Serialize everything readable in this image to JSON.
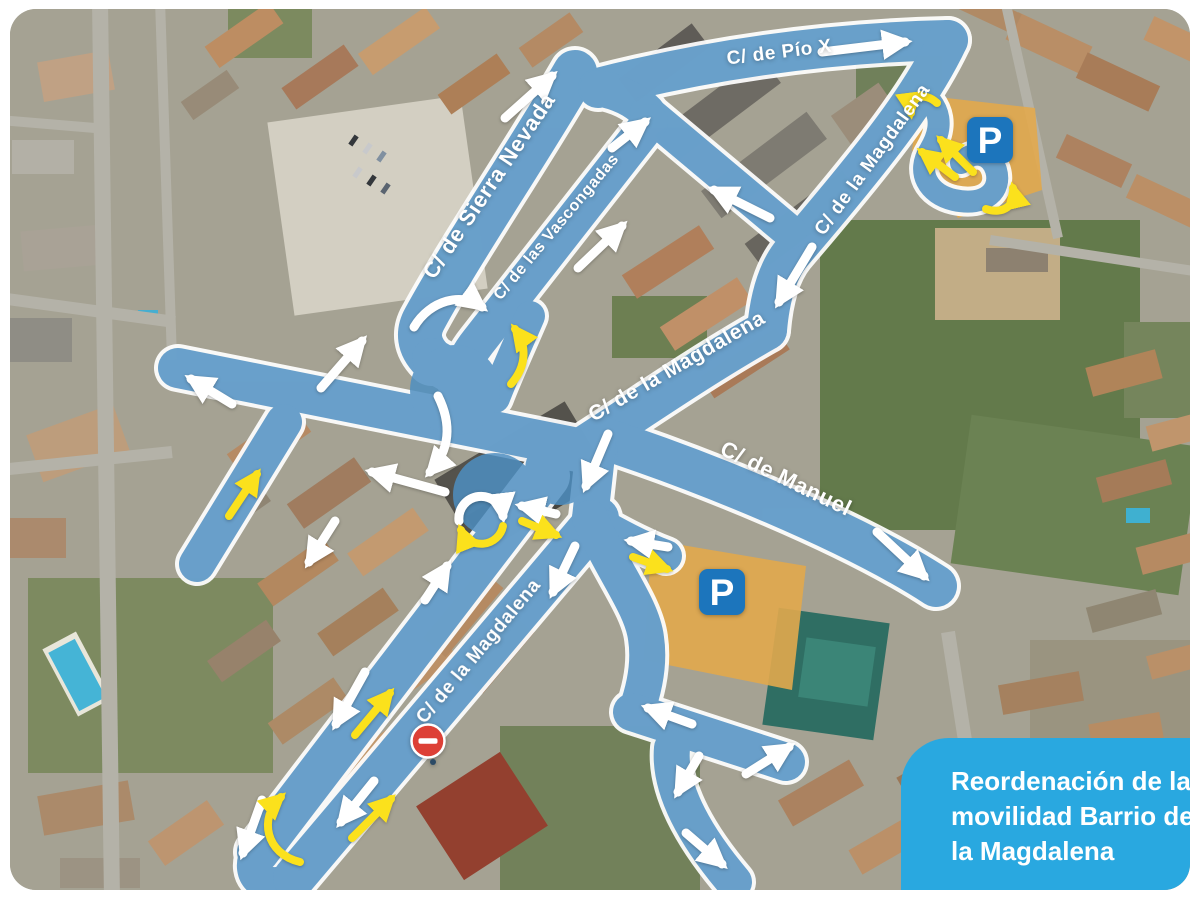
{
  "title_card": {
    "lines": [
      "Reordenación de la",
      "movilidad Barrio de",
      "la Magdalena"
    ]
  },
  "map": {
    "street_labels": [
      {
        "text": "C/ de Pío X",
        "x": 780,
        "y": 58,
        "angle": -7,
        "size": 19
      },
      {
        "text": "C/ de Sierra Nevada",
        "x": 495,
        "y": 190,
        "angle": -56,
        "size": 22
      },
      {
        "text": "C/ de las Vascongadas",
        "x": 560,
        "y": 230,
        "angle": -50,
        "size": 16
      },
      {
        "text": "C/ de la Magdalena",
        "x": 877,
        "y": 163,
        "angle": -54,
        "size": 19
      },
      {
        "text": "C/ de la Magdalena",
        "x": 680,
        "y": 372,
        "angle": -30,
        "size": 21
      },
      {
        "text": "C/ de Manuel",
        "x": 783,
        "y": 485,
        "angle": 26,
        "size": 22
      },
      {
        "text": "C/ de la Magdalena",
        "x": 483,
        "y": 655,
        "angle": -50,
        "size": 19
      }
    ],
    "parking_letter": "P",
    "parking_icons": [
      {
        "x": 990,
        "y": 140
      },
      {
        "x": 722,
        "y": 592
      }
    ],
    "no_entry_sign": {
      "x": 428,
      "y": 741
    },
    "arrows": {
      "straight": [
        {
          "x1": 822,
          "y1": 52,
          "x2": 905,
          "y2": 42,
          "color": "white"
        },
        {
          "x1": 505,
          "y1": 118,
          "x2": 552,
          "y2": 76,
          "color": "white"
        },
        {
          "x1": 612,
          "y1": 148,
          "x2": 645,
          "y2": 122,
          "color": "white"
        },
        {
          "x1": 578,
          "y1": 268,
          "x2": 622,
          "y2": 226,
          "color": "white"
        },
        {
          "x1": 770,
          "y1": 218,
          "x2": 714,
          "y2": 190,
          "color": "white"
        },
        {
          "x1": 812,
          "y1": 247,
          "x2": 779,
          "y2": 302,
          "color": "white"
        },
        {
          "x1": 608,
          "y1": 434,
          "x2": 586,
          "y2": 486,
          "color": "white"
        },
        {
          "x1": 556,
          "y1": 514,
          "x2": 522,
          "y2": 506,
          "color": "white"
        },
        {
          "x1": 522,
          "y1": 521,
          "x2": 556,
          "y2": 535,
          "color": "yellow"
        },
        {
          "x1": 575,
          "y1": 546,
          "x2": 553,
          "y2": 592,
          "color": "white"
        },
        {
          "x1": 425,
          "y1": 600,
          "x2": 447,
          "y2": 566,
          "color": "white"
        },
        {
          "x1": 668,
          "y1": 547,
          "x2": 631,
          "y2": 541,
          "color": "white"
        },
        {
          "x1": 633,
          "y1": 557,
          "x2": 667,
          "y2": 569,
          "color": "yellow"
        },
        {
          "x1": 877,
          "y1": 532,
          "x2": 924,
          "y2": 576,
          "color": "white"
        },
        {
          "x1": 232,
          "y1": 404,
          "x2": 191,
          "y2": 379,
          "color": "white"
        },
        {
          "x1": 321,
          "y1": 388,
          "x2": 362,
          "y2": 341,
          "color": "white"
        },
        {
          "x1": 229,
          "y1": 516,
          "x2": 257,
          "y2": 474,
          "color": "yellow"
        },
        {
          "x1": 445,
          "y1": 492,
          "x2": 372,
          "y2": 472,
          "color": "white"
        },
        {
          "x1": 335,
          "y1": 521,
          "x2": 309,
          "y2": 562,
          "color": "white"
        },
        {
          "x1": 365,
          "y1": 672,
          "x2": 336,
          "y2": 724,
          "color": "white"
        },
        {
          "x1": 355,
          "y1": 735,
          "x2": 390,
          "y2": 693,
          "color": "yellow"
        },
        {
          "x1": 262,
          "y1": 800,
          "x2": 243,
          "y2": 853,
          "color": "white"
        },
        {
          "x1": 374,
          "y1": 781,
          "x2": 341,
          "y2": 822,
          "color": "white"
        },
        {
          "x1": 352,
          "y1": 838,
          "x2": 391,
          "y2": 799,
          "color": "yellow"
        },
        {
          "x1": 692,
          "y1": 724,
          "x2": 648,
          "y2": 708,
          "color": "white"
        },
        {
          "x1": 746,
          "y1": 774,
          "x2": 789,
          "y2": 747,
          "color": "white"
        },
        {
          "x1": 699,
          "y1": 756,
          "x2": 678,
          "y2": 792,
          "color": "white"
        },
        {
          "x1": 686,
          "y1": 833,
          "x2": 722,
          "y2": 864,
          "color": "white"
        },
        {
          "x1": 973,
          "y1": 172,
          "x2": 941,
          "y2": 140,
          "color": "yellow"
        },
        {
          "x1": 955,
          "y1": 177,
          "x2": 922,
          "y2": 152,
          "color": "yellow"
        }
      ],
      "curved": [
        {
          "d": "M 459,521 A 22,22 0 0 1 503,516",
          "color": "white"
        },
        {
          "d": "M 503,526 A 22,22 0 0 1 461,530",
          "color": "yellow"
        },
        {
          "d": "M 414,327 C 430,300 462,292 482,307",
          "color": "white"
        },
        {
          "d": "M 511,384 C 527,366 527,345 515,329",
          "color": "yellow"
        },
        {
          "d": "M 300,862 C 266,854 258,818 281,797",
          "color": "yellow"
        },
        {
          "d": "M 937,103 C 924,91 909,97 911,113",
          "color": "yellow"
        },
        {
          "d": "M 986,209 C 1003,215 1017,205 1013,188",
          "color": "yellow"
        },
        {
          "d": "M 438,396 C 452,424 450,450 430,472",
          "color": "white"
        }
      ]
    },
    "colors": {
      "road": "#4e8fc2",
      "casing": "#ffffff",
      "arrow_white": "#ffffff",
      "arrow_yellow": "#fbe11c",
      "parking_zone": "#e2a84c",
      "parking_sign": "#1c75bc",
      "no_entry": "#dd4036",
      "card": "#29a8e0"
    }
  }
}
